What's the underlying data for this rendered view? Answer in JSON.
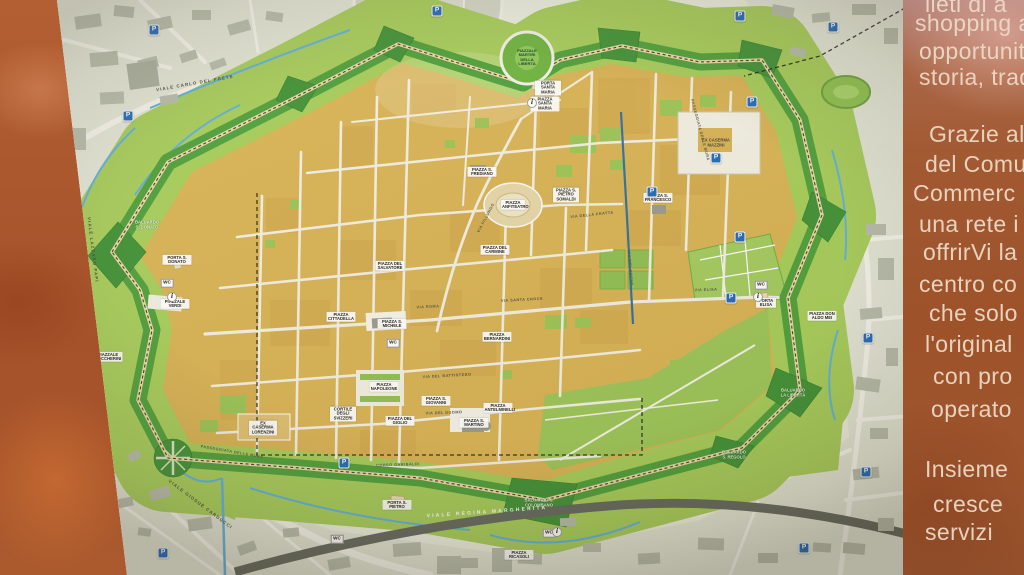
{
  "side_panel": {
    "lines": [
      {
        "text": "lieti di a",
        "top": -9,
        "indent": 22
      },
      {
        "text": "shopping all'i",
        "top": 10,
        "indent": 12
      },
      {
        "text": "opportunità",
        "top": 38,
        "indent": 16
      },
      {
        "text": "storia, tradiz",
        "top": 64,
        "indent": 16
      },
      {
        "text": "Grazie al so",
        "top": 121,
        "indent": 26
      },
      {
        "text": "del Comun",
        "top": 151,
        "indent": 22
      },
      {
        "text": "Commerc",
        "top": 180,
        "indent": 10
      },
      {
        "text": "una rete i",
        "top": 211,
        "indent": 16
      },
      {
        "text": "offrirVi la",
        "top": 239,
        "indent": 20
      },
      {
        "text": "centro co",
        "top": 271,
        "indent": 16
      },
      {
        "text": "che solo",
        "top": 300,
        "indent": 26
      },
      {
        "text": "l'original",
        "top": 331,
        "indent": 22
      },
      {
        "text": "con pro",
        "top": 363,
        "indent": 30
      },
      {
        "text": "operato",
        "top": 396,
        "indent": 28
      },
      {
        "text": "Insieme",
        "top": 456,
        "indent": 22
      },
      {
        "text": "cresce",
        "top": 491,
        "indent": 30
      },
      {
        "text": "servizi",
        "top": 519,
        "indent": 22
      }
    ]
  },
  "map": {
    "parking_letter": "P",
    "wc_label": "WC",
    "info_label": "i",
    "colors": {
      "ramparts_green": "#4d9f3a",
      "bastion_green": "#3f9136",
      "esplanade_green": "#a6cd5a",
      "city_gold": "#d8b254",
      "water_blue": "#5db0e0",
      "parking_blue": "#2268b8",
      "panel_terracotta": "#9d5229"
    },
    "labels": [
      {
        "text": "PIAZZA ANFITEATRO",
        "x": 513,
        "y": 205,
        "type": "piazza",
        "w": 22
      },
      {
        "text": "PIAZZA S. FREDIANO",
        "x": 482,
        "y": 172,
        "type": "piazza"
      },
      {
        "text": "PIAZZA S. PIETRO SOMALDI",
        "x": 566,
        "y": 195,
        "type": "piazza",
        "w": 24
      },
      {
        "text": "PIAZZA S. FRANCESCO",
        "x": 658,
        "y": 198,
        "type": "piazza"
      },
      {
        "text": "PIAZZA DEL CARMINE",
        "x": 495,
        "y": 250,
        "type": "piazza"
      },
      {
        "text": "PIAZZA DEL SALVATORE",
        "x": 390,
        "y": 266,
        "type": "piazza"
      },
      {
        "text": "PIAZZA S. MICHELE",
        "x": 392,
        "y": 324,
        "type": "piazza"
      },
      {
        "text": "PIAZZA CITTADELLA",
        "x": 341,
        "y": 317,
        "type": "piazza"
      },
      {
        "text": "PIAZZA BERNARDINI",
        "x": 497,
        "y": 337,
        "type": "piazza"
      },
      {
        "text": "PIAZZA NAPOLEONE",
        "x": 384,
        "y": 387,
        "type": "piazza"
      },
      {
        "text": "PIAZZA DEL GIGLIO",
        "x": 400,
        "y": 421,
        "type": "piazza"
      },
      {
        "text": "PIAZZA S. GIOVANNI",
        "x": 436,
        "y": 401,
        "type": "piazza"
      },
      {
        "text": "PIAZZA S. MARTINO",
        "x": 474,
        "y": 423,
        "type": "piazza"
      },
      {
        "text": "PIAZZA ANTELMINELLI",
        "x": 498,
        "y": 408,
        "type": "piazza"
      },
      {
        "text": "CORTILE DEGLI SVIZZERI",
        "x": 343,
        "y": 414,
        "type": "piazza",
        "w": 24
      },
      {
        "text": "PIAZZA SANTA MARIA",
        "x": 545,
        "y": 104,
        "type": "piazza"
      },
      {
        "text": "PORTA SANTA MARIA",
        "x": 548,
        "y": 88,
        "type": "piazza",
        "w": 24
      },
      {
        "text": "PORTA S. PIETRO",
        "x": 397,
        "y": 505,
        "type": "piazza"
      },
      {
        "text": "PORTA ELISA",
        "x": 766,
        "y": 303,
        "type": "piazza",
        "w": 18
      },
      {
        "text": "PORTA S. DONATO",
        "x": 177,
        "y": 260,
        "type": "piazza"
      },
      {
        "text": "PIAZZALE VERDI",
        "x": 175,
        "y": 304,
        "type": "piazza"
      },
      {
        "text": "PIAZZALE BOCCHERINI",
        "x": 108,
        "y": 357,
        "type": "piazza"
      },
      {
        "text": "PIAZZA DON ALDO MEI",
        "x": 822,
        "y": 316,
        "type": "piazza"
      },
      {
        "text": "PIAZZA RICASOLI",
        "x": 519,
        "y": 555,
        "type": "piazza"
      },
      {
        "text": "EX CASERMA MAZZINI",
        "x": 716,
        "y": 143,
        "type": "plain",
        "w": 30
      },
      {
        "text": "EX CASERMA LORENZINI",
        "x": 263,
        "y": 428,
        "type": "piazza",
        "w": 26
      },
      {
        "text": "PIAZZALE MARTIRI DELLA LIBERTÀ",
        "x": 527,
        "y": 58,
        "type": "green-circle"
      },
      {
        "text": "BALUARDO S. DONATO",
        "x": 147,
        "y": 225,
        "type": "green",
        "w": 26
      },
      {
        "text": "BALUARDO S. COLOMBANO",
        "x": 539,
        "y": 503,
        "type": "green",
        "w": 30
      },
      {
        "text": "BALUARDO LA LIBERTÀ",
        "x": 793,
        "y": 393,
        "type": "green",
        "w": 26
      },
      {
        "text": "BALUARDO S. REGOLO",
        "x": 734,
        "y": 455,
        "type": "green",
        "w": 26
      },
      {
        "text": "VIALE CARLO DEL PRETE",
        "x": 195,
        "y": 84,
        "rot": -10,
        "type": "street"
      },
      {
        "text": "VIALE LAZZARO PAPI",
        "x": 92,
        "y": 250,
        "rot": 83,
        "type": "street"
      },
      {
        "text": "VIALE GIOSUÈ CARDUCCI",
        "x": 200,
        "y": 505,
        "rot": 37,
        "type": "street"
      },
      {
        "text": "VIALE REGINA MARGHERITA",
        "x": 487,
        "y": 513,
        "rot": -4,
        "type": "street-dark"
      },
      {
        "text": "CORSO GARIBALDI",
        "x": 398,
        "y": 465,
        "rot": -2,
        "type": "street-sm"
      },
      {
        "text": "VIA ROMA",
        "x": 428,
        "y": 307,
        "rot": -3,
        "type": "street-sm"
      },
      {
        "text": "VIA SANTA CROCE",
        "x": 522,
        "y": 300,
        "rot": -3,
        "type": "street-sm"
      },
      {
        "text": "VIA FILLUNGO",
        "x": 486,
        "y": 218,
        "rot": -62,
        "type": "street-sm"
      },
      {
        "text": "VIA DELLA FRATTA",
        "x": 592,
        "y": 215,
        "rot": -6,
        "type": "street-sm"
      },
      {
        "text": "VIA DEL FOSSO",
        "x": 630,
        "y": 268,
        "rot": 85,
        "type": "street-sm"
      },
      {
        "text": "VIA ELISA",
        "x": 706,
        "y": 290,
        "rot": -2,
        "type": "street-sm"
      },
      {
        "text": "VIA DEL DUOMO",
        "x": 444,
        "y": 413,
        "rot": -2,
        "type": "street-sm"
      },
      {
        "text": "VIA DEL BATTISTERO",
        "x": 447,
        "y": 376,
        "rot": -3,
        "type": "street-sm"
      },
      {
        "text": "PASSEGGIATA DELLE MURA",
        "x": 700,
        "y": 130,
        "rot": 75,
        "type": "street-sm"
      },
      {
        "text": "PASSEGGIATA DELLE MURA",
        "x": 232,
        "y": 452,
        "rot": 10,
        "type": "street-sm"
      }
    ],
    "parking": [
      [
        154,
        30
      ],
      [
        128,
        116
      ],
      [
        437,
        11
      ],
      [
        740,
        16
      ],
      [
        833,
        27
      ],
      [
        752,
        102
      ],
      [
        716,
        158
      ],
      [
        652,
        192
      ],
      [
        740,
        237
      ],
      [
        731,
        298
      ],
      [
        868,
        338
      ],
      [
        344,
        463
      ],
      [
        163,
        553
      ],
      [
        804,
        548
      ],
      [
        866,
        472
      ]
    ],
    "wc": [
      [
        167,
        283
      ],
      [
        393,
        343
      ],
      [
        761,
        285
      ],
      [
        337,
        539
      ],
      [
        549,
        533
      ]
    ],
    "info": [
      [
        172,
        297
      ],
      [
        758,
        297
      ],
      [
        532,
        103
      ],
      [
        557,
        532
      ]
    ]
  }
}
